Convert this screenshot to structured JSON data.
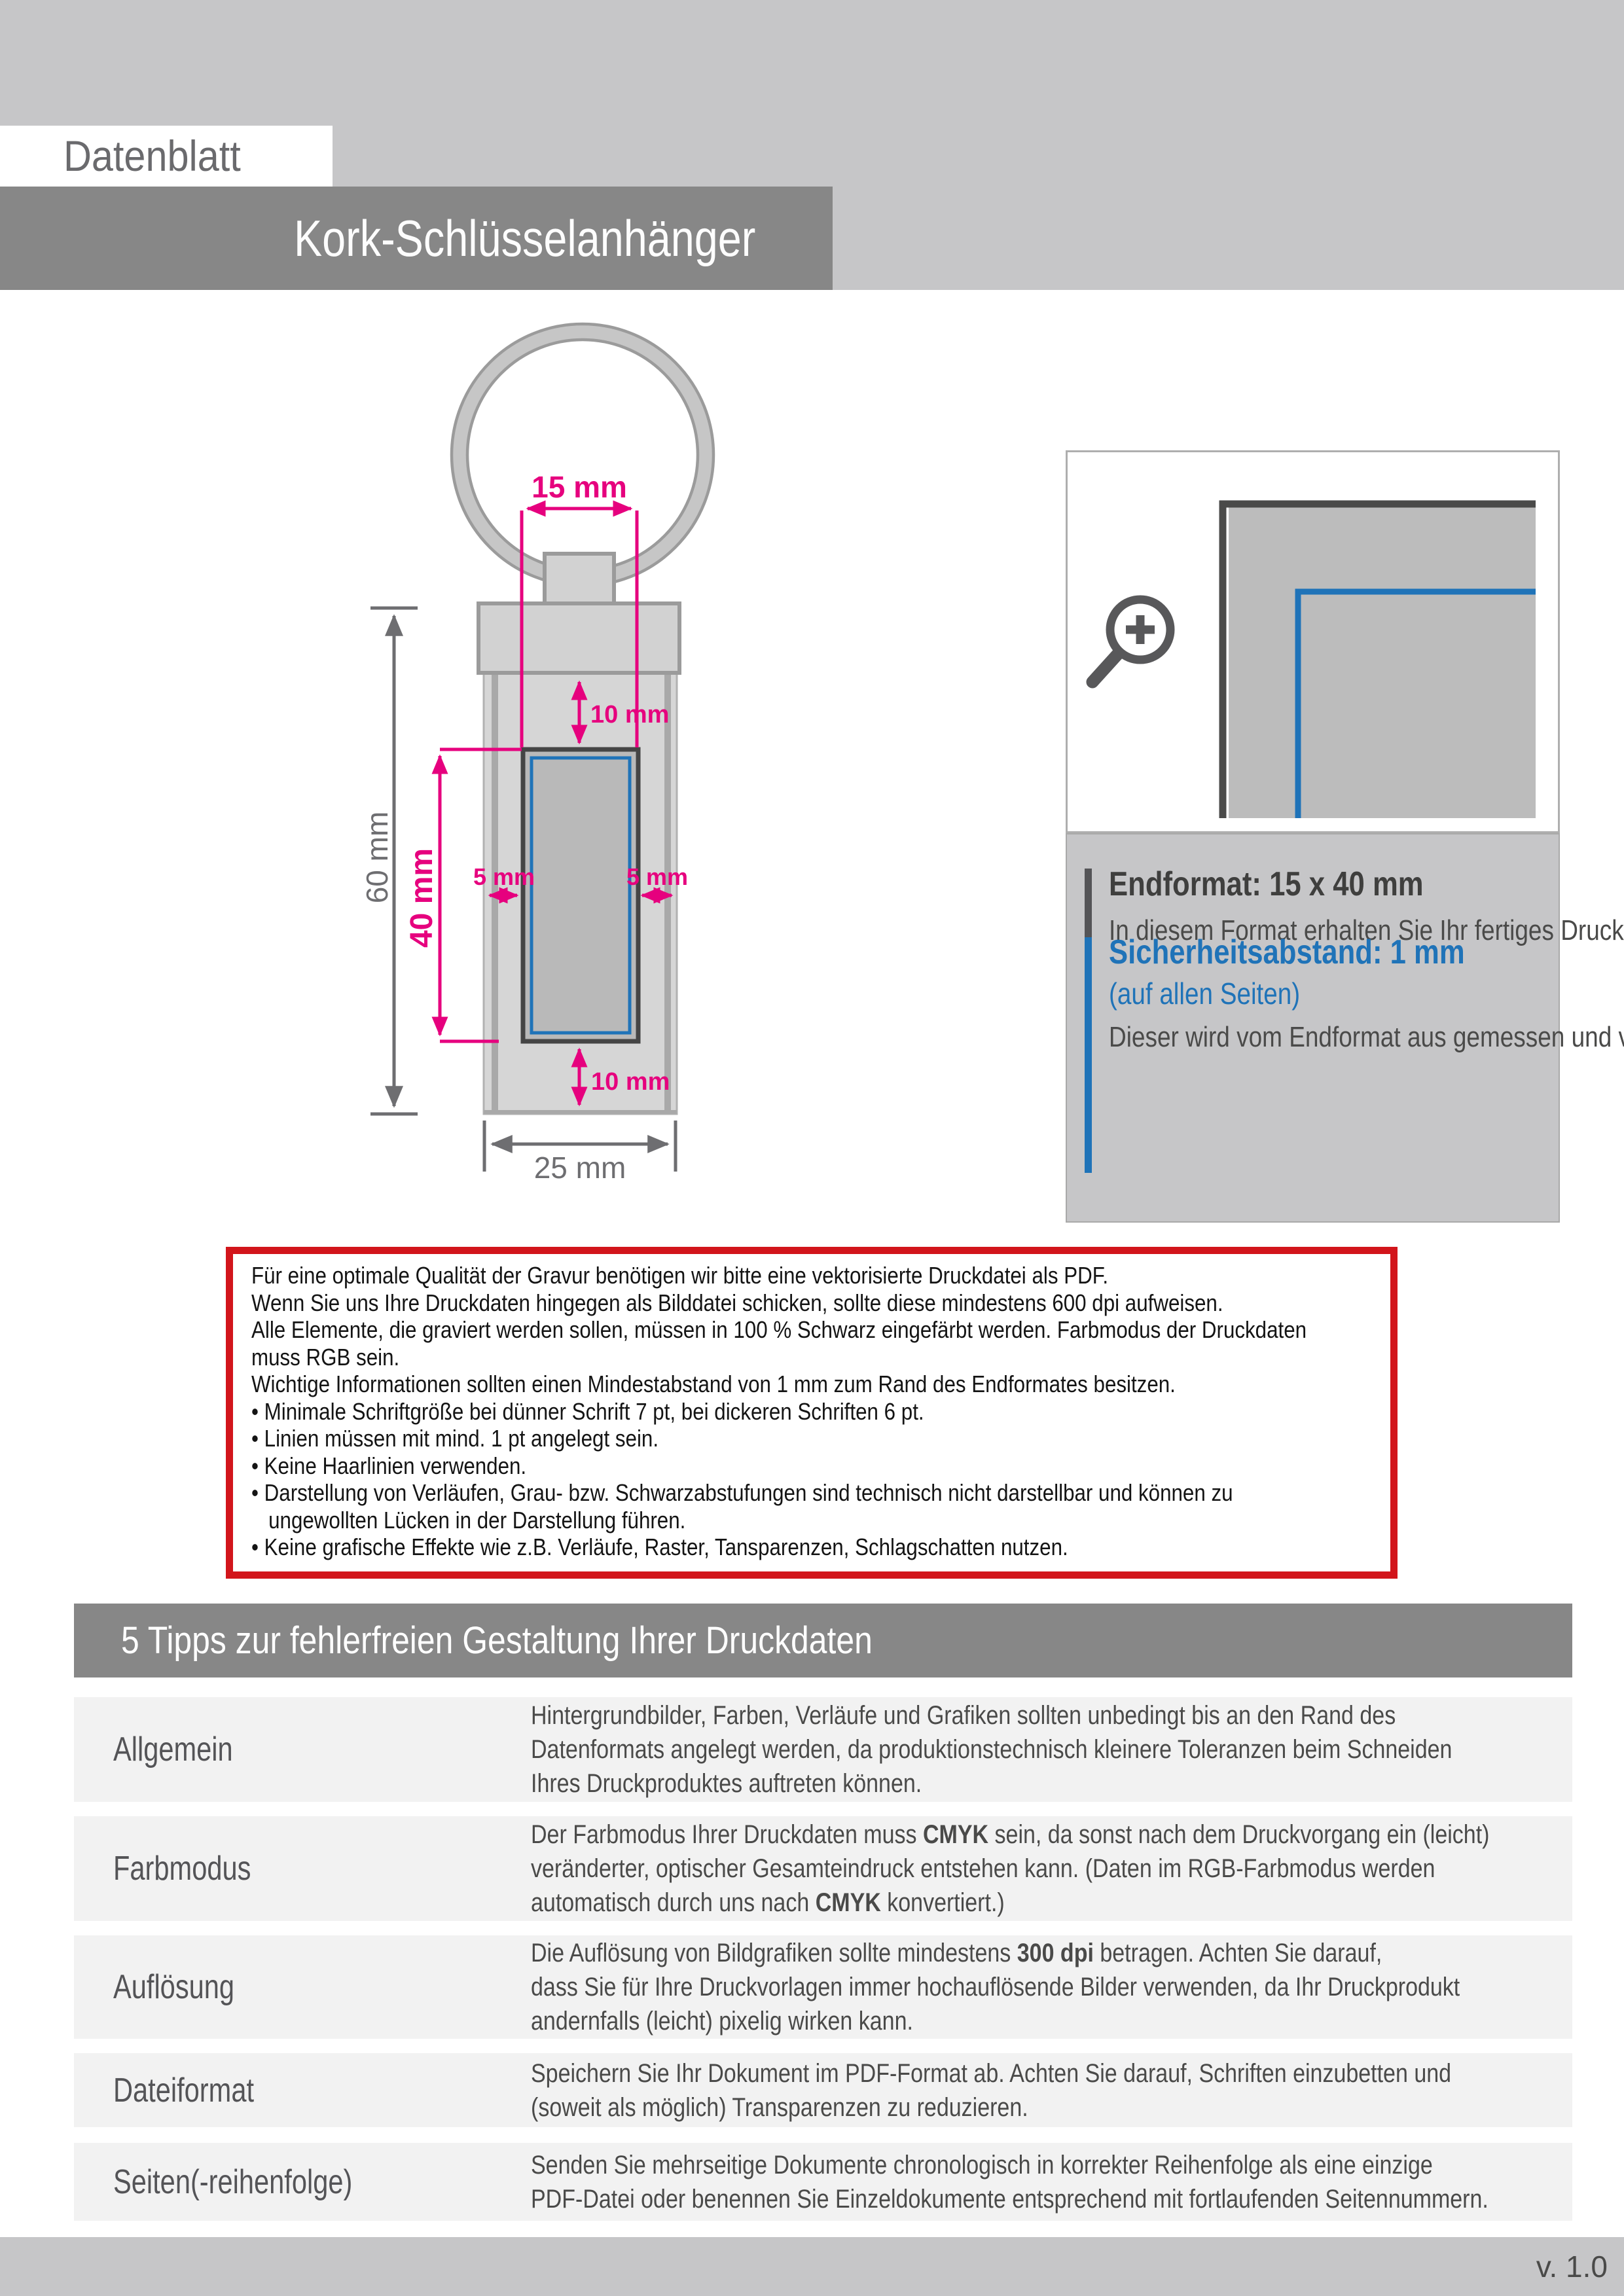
{
  "header": {
    "kicker": "Datenblatt",
    "title": "Kork-Schlüsselanhänger"
  },
  "drawing": {
    "dim_print_width": "15 mm",
    "dim_top_margin": "10 mm",
    "dim_total_height": "60 mm",
    "dim_print_height": "40 mm",
    "dim_side_left": "5 mm",
    "dim_side_right": "5 mm",
    "dim_bottom_margin": "10 mm",
    "dim_total_width": "25 mm"
  },
  "info_panel": {
    "endformat_title": "Endformat: 15 x 40 mm",
    "endformat_body": "In diesem Format erhalten Sie Ihr fertiges\nDruckprodukt.",
    "safety_title": "Sicherheitsabstand: 1 mm",
    "safety_subtitle": "(auf allen Seiten)",
    "safety_body": "Dieser wird vom Endformat aus gemessen\nund verhindert unerwünschten Anschnitt\nIhrer Texte und Informationen während\nder Produktion."
  },
  "notice_box": {
    "lines": [
      "Für eine optimale Qualität der Gravur benötigen wir bitte eine vektorisierte Druckdatei als PDF.",
      "Wenn Sie uns Ihre Druckdaten hingegen als Bilddatei schicken, sollte diese mindestens 600 dpi aufweisen.",
      "Alle Elemente, die graviert werden sollen, müssen in 100 % Schwarz eingefärbt werden. Farbmodus der Druckdaten",
      "muss RGB sein.",
      "Wichtige Informationen sollten einen Mindestabstand von 1 mm zum Rand des Endformates besitzen.",
      "• Minimale Schriftgröße bei dünner Schrift 7 pt, bei dickeren Schriften 6 pt.",
      "• Linien müssen mit mind. 1 pt angelegt sein.",
      "• Keine Haarlinien verwenden.",
      "• Darstellung von Verläufen, Grau- bzw. Schwarzabstufungen sind technisch nicht darstellbar und können zu",
      "   ungewollten Lücken in der Darstellung führen.",
      "• Keine grafische Effekte wie z.B. Verläufe, Raster, Tansparenzen, Schlagschatten nutzen."
    ]
  },
  "tips": {
    "title": "5 Tipps zur fehlerfreien Gestaltung Ihrer Druckdaten",
    "rows": [
      {
        "label": "Allgemein",
        "lines": [
          [
            [
              "Hintergrundbilder, Farben, Verläufe und Grafiken sollten unbedingt bis an den Rand des",
              0
            ]
          ],
          [
            [
              "Datenformats angelegt werden, da produktionstechnisch kleinere Toleranzen beim Schneiden",
              0
            ]
          ],
          [
            [
              "Ihres Druckproduktes auftreten können.",
              0
            ]
          ]
        ]
      },
      {
        "label": "Farbmodus",
        "lines": [
          [
            [
              "Der Farbmodus Ihrer Druckdaten muss ",
              0
            ],
            [
              "CMYK",
              1
            ],
            [
              " sein, da sonst nach dem Druckvorgang ein (leicht)",
              0
            ]
          ],
          [
            [
              "veränderter, optischer Gesamteindruck entstehen kann. (Daten im RGB-Farbmodus werden",
              0
            ]
          ],
          [
            [
              "automatisch durch uns nach ",
              0
            ],
            [
              "CMYK",
              1
            ],
            [
              " konvertiert.)",
              0
            ]
          ]
        ]
      },
      {
        "label": "Auflösung",
        "lines": [
          [
            [
              "Die Auflösung von Bildgrafiken sollte mindestens ",
              0
            ],
            [
              "300 dpi",
              1
            ],
            [
              " betragen. Achten Sie darauf,",
              0
            ]
          ],
          [
            [
              "dass Sie für Ihre Druckvorlagen immer hochauflösende Bilder verwenden, da Ihr Druckprodukt",
              0
            ]
          ],
          [
            [
              "andernfalls (leicht) pixelig wirken kann.",
              0
            ]
          ]
        ]
      },
      {
        "label": "Dateiformat",
        "lines": [
          [
            [
              "Speichern Sie Ihr Dokument im PDF-Format ab. Achten Sie darauf, Schriften einzubetten und",
              0
            ]
          ],
          [
            [
              "(soweit als möglich) Transparenzen zu reduzieren.",
              0
            ]
          ]
        ]
      },
      {
        "label": "Seiten(-reihenfolge)",
        "lines": [
          [
            [
              "Senden Sie mehrseitige Dokumente chronologisch in korrekter Reihenfolge als eine einzige",
              0
            ]
          ],
          [
            [
              "PDF-Datei oder benennen Sie Einzeldokumente entsprechend mit fortlaufenden Seitennummern.",
              0
            ]
          ]
        ]
      }
    ]
  },
  "footer": {
    "version": "v. 1.0"
  },
  "colors": {
    "magenta": "#e6007e",
    "blue": "#1f73b8",
    "red": "#d2151b",
    "band_gray": "#c6c6c8",
    "bar_gray": "#878787",
    "row_gray": "#f2f2f2"
  }
}
